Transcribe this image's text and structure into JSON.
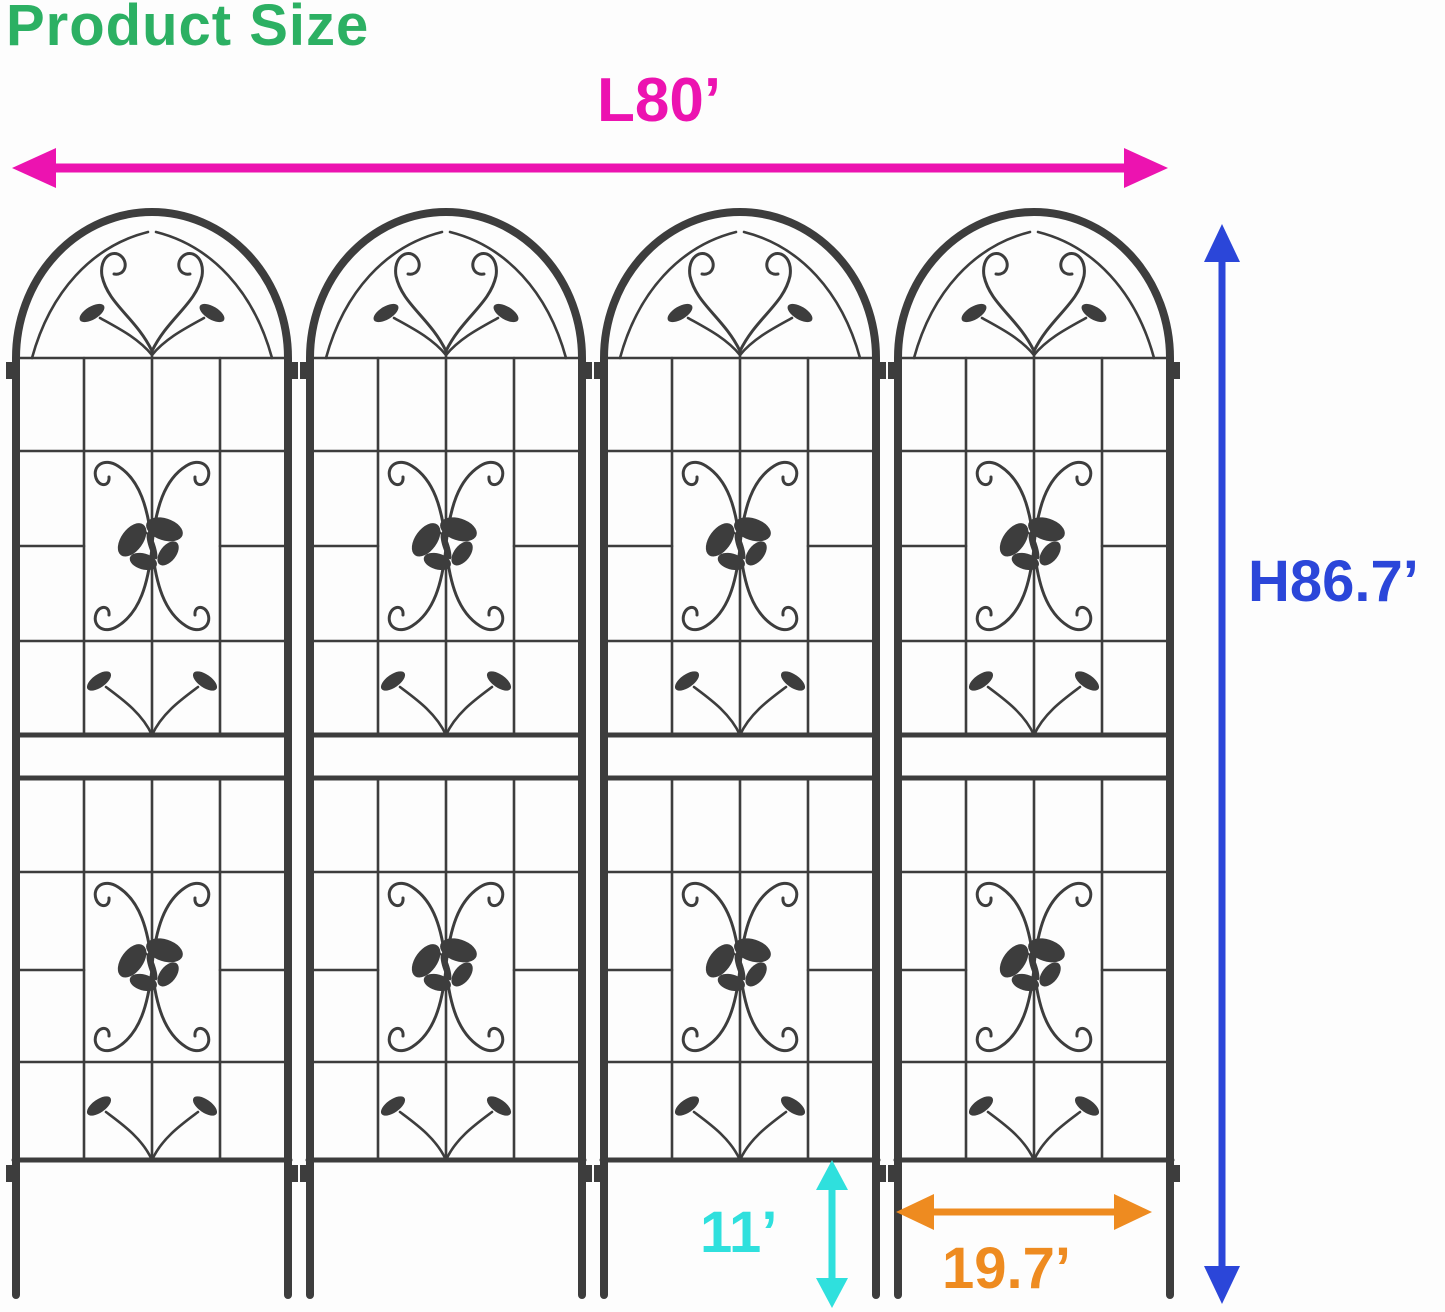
{
  "title": "Product Size",
  "colors": {
    "title-green": "#2cb063",
    "magenta": "#ec13b0",
    "blue": "#2b46d9",
    "cyan": "#2fe0dd",
    "orange": "#ee8b20",
    "wire": "#3d3d3d",
    "bg": "#fdfdfd"
  },
  "dimensions": {
    "length": {
      "label": "L80’",
      "color": "#ec13b0"
    },
    "height": {
      "label": "H86.7’",
      "color": "#2b46d9"
    },
    "ground_stake": {
      "label": "11’",
      "color": "#2fe0dd"
    },
    "panel_width": {
      "label": "19.7’",
      "color": "#ee8b20"
    }
  },
  "icons": {
    "length_arrow": "double-headed-horizontal-arrow",
    "height_arrow": "double-headed-vertical-arrow",
    "ground_stake_arrow": "double-headed-vertical-arrow",
    "panel_width_arrow": "double-headed-horizontal-arrow",
    "panel_ornaments": [
      "butterfly-icon",
      "leaf-icon",
      "scroll-icon"
    ]
  },
  "product": {
    "type": "arched metal garden trellis panel with butterfly, scroll and leaf ornaments",
    "panel_count": 4
  }
}
